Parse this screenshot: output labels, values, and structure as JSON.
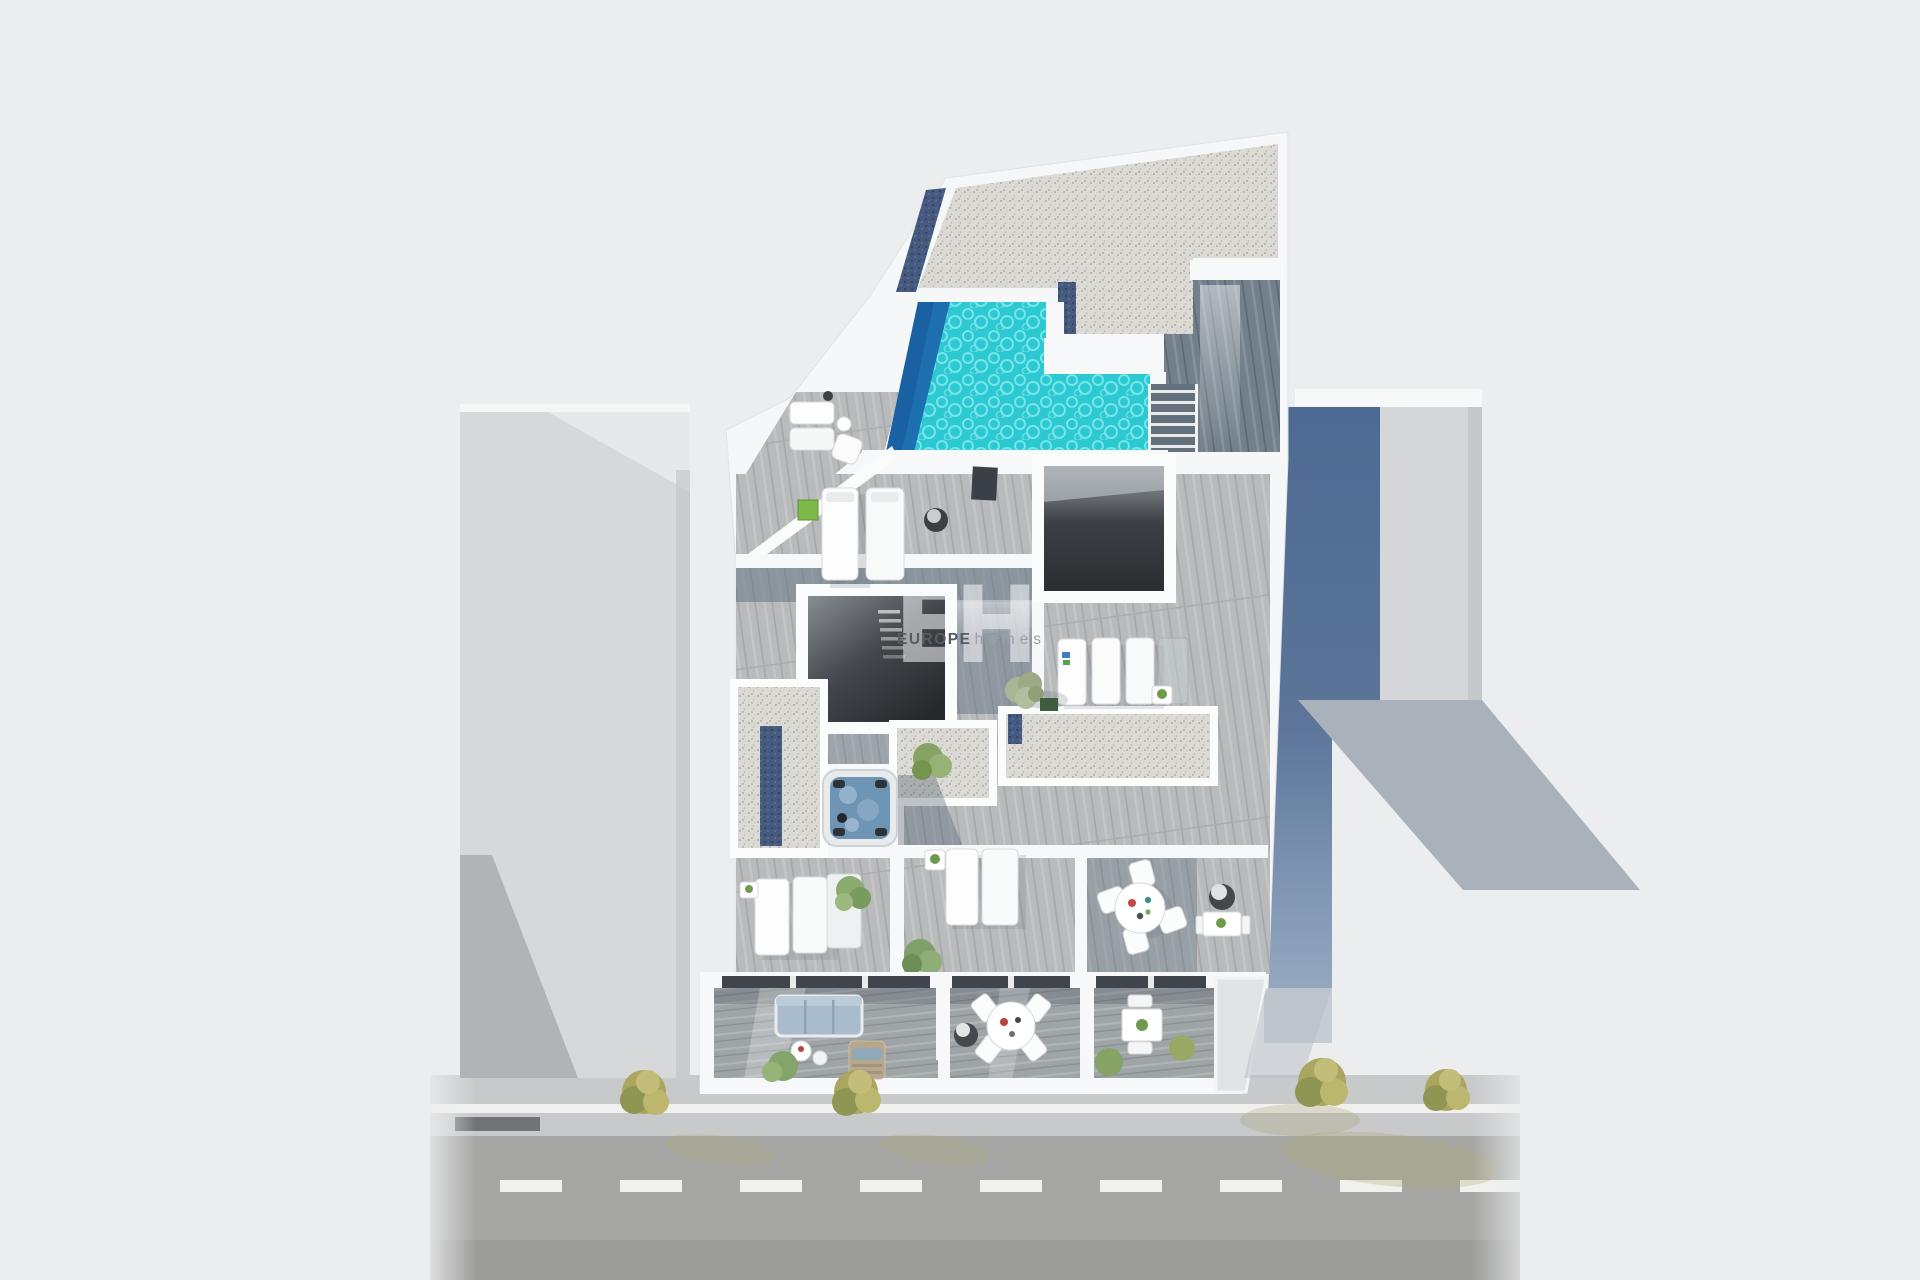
{
  "watermark": {
    "initials": "EH",
    "brand_bold": "EUROPE",
    "brand_light": "homes"
  },
  "colors": {
    "background": "#ecedee",
    "pool_water": "#2cc9d3",
    "pool_water_texture": "#8feef0",
    "pool_shadow_edge": "#1e6fb0",
    "gravel": "#dcdad5",
    "deck_light": "#b8babb",
    "deck_slate": "#5d6f80",
    "wall_white": "#f7f8f9",
    "void_dark": "#2b2e31",
    "solar_strip_blue": "#46597e",
    "neighbor_gray": "#d5d7d9",
    "shade_slate_blue": "#4d6a92",
    "ground_shadow": "#a9b2ba",
    "road": "#a5a6a4",
    "sidewalk": "#c8c9ca",
    "curb_dark": "#717375",
    "lane_line": "#f0f1ef",
    "tree_green": "#7fa068",
    "street_tree_yellow": "#aaa55f",
    "jacuzzi_water": "#6f95b5",
    "sofa_blue": "#a9bccb"
  }
}
